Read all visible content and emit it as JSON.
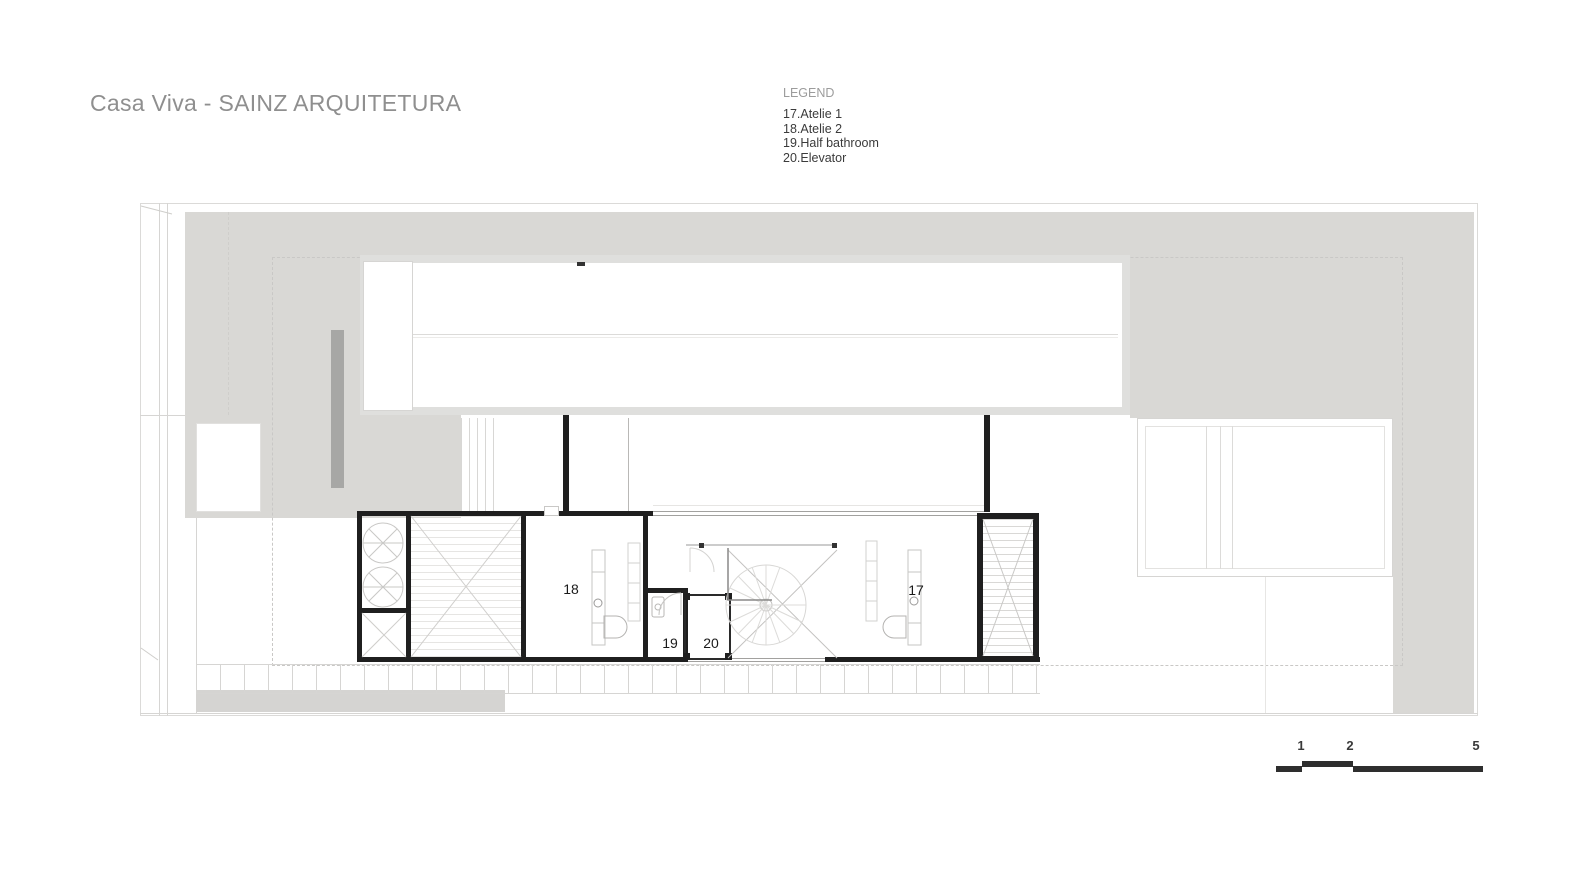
{
  "header": {
    "title": "Casa Viva - SAINZ ARQUITETURA"
  },
  "legend": {
    "title": "LEGEND",
    "items": [
      "17.Atelie 1",
      "18.Atelie 2",
      "19.Half bathroom",
      "20.Elevator"
    ]
  },
  "plan": {
    "labels": {
      "atelie1": "17",
      "atelie2": "18",
      "half_bathroom": "19",
      "elevator": "20"
    }
  },
  "scale_bar": {
    "labels": [
      "1",
      "2",
      "5"
    ]
  },
  "colors": {
    "site_fill": "#d9d8d5",
    "dark_strip": "#a7a7a5",
    "wall": "#1f1f1f",
    "roof_border": "#dfdfdd",
    "title_text": "#8f8f8f",
    "legend_text": "#3b3b3b",
    "scale_bar": "#2e2e2e"
  }
}
